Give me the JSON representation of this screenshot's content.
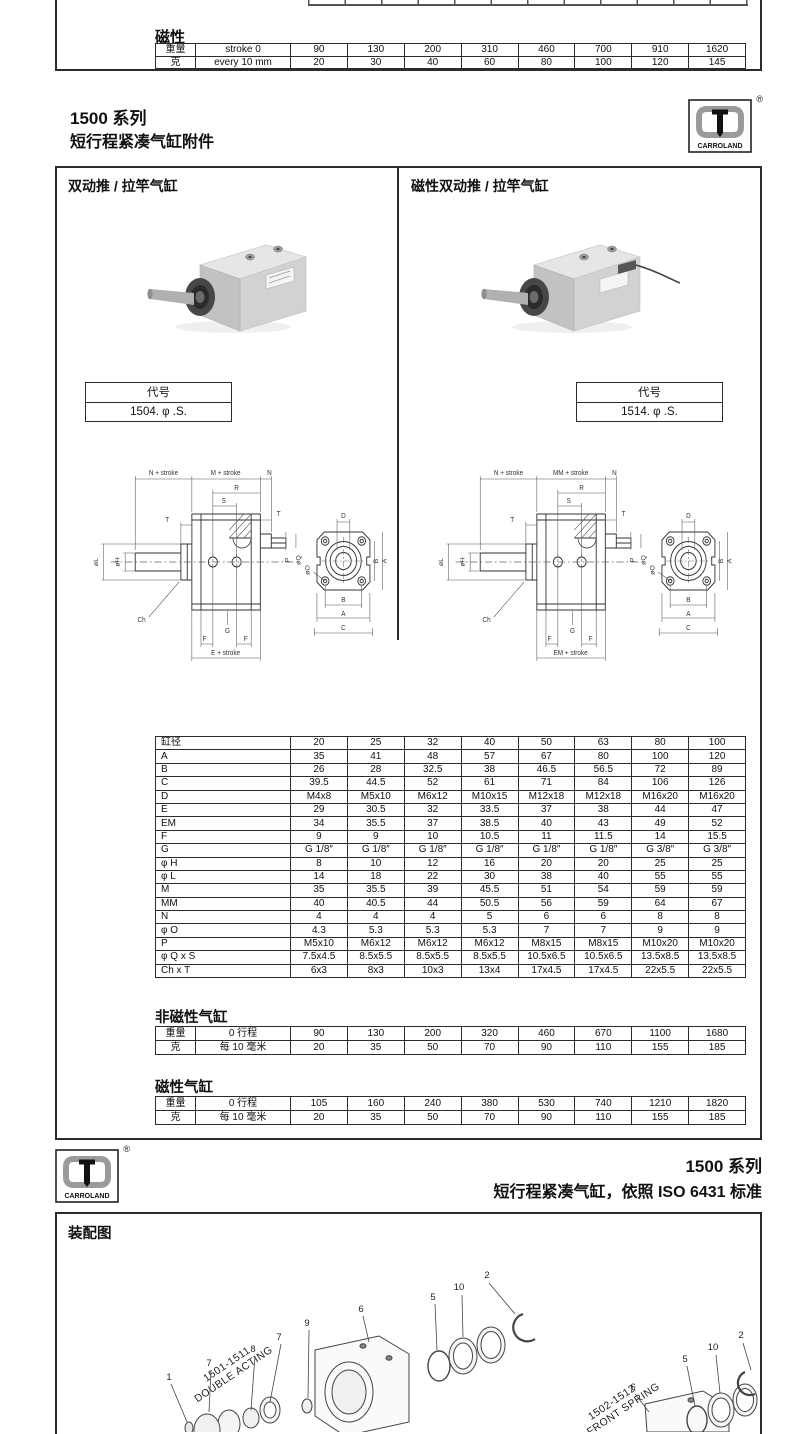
{
  "top_remnant": {
    "heading": "磁性",
    "table": {
      "rows": [
        [
          "重量",
          "stroke 0",
          "90",
          "130",
          "200",
          "310",
          "460",
          "700",
          "910",
          "1620"
        ],
        [
          "克",
          "every 10 mm",
          "20",
          "30",
          "40",
          "60",
          "80",
          "100",
          "120",
          "145"
        ]
      ]
    }
  },
  "header": {
    "series": "1500 系列",
    "subtitle": "短行程紧凑气缸附件",
    "logo": {
      "text": "CARROLAND",
      "reg": "®"
    }
  },
  "main": {
    "left": {
      "title": "双动推 / 拉竿气缸",
      "code_header": "代号",
      "code": "1504. φ .S.",
      "drawing": {
        "n_stroke": "N + stroke",
        "m_stroke": "M + stroke",
        "n": "N",
        "r": "R",
        "s": "S",
        "t_left": "T",
        "t_right": "T",
        "p": "P",
        "oq": "øQ",
        "ol": "øL",
        "oh": "øH",
        "ch": "Ch",
        "g": "G",
        "f_left": "F",
        "f_right": "F",
        "e_stroke": "E + stroke",
        "d": "D",
        "b_right": "B",
        "a_right": "A",
        "oo": "øO",
        "b_bottom": "B",
        "a_bottom": "A",
        "c_bottom": "C"
      }
    },
    "right": {
      "title": "磁性双动推 / 拉竿气缸",
      "code_header": "代号",
      "code": "1514. φ .S.",
      "drawing": {
        "n_stroke": "N + stroke",
        "m_stroke": "MM + stroke",
        "n": "N",
        "r": "R",
        "s": "S",
        "t_left": "T",
        "t_right": "T",
        "p": "P",
        "oq": "øQ",
        "ol": "øL",
        "oh": "øH",
        "ch": "Ch",
        "g": "G",
        "f_left": "F",
        "f_right": "F",
        "e_stroke": "EM + stroke",
        "d": "D",
        "b_right": "B",
        "a_right": "A",
        "oo": "øO",
        "b_bottom": "B",
        "a_bottom": "A",
        "c_bottom": "C"
      }
    },
    "dimension_table": {
      "rows": [
        [
          "缸径",
          "20",
          "25",
          "32",
          "40",
          "50",
          "63",
          "80",
          "100"
        ],
        [
          "A",
          "35",
          "41",
          "48",
          "57",
          "67",
          "80",
          "100",
          "120"
        ],
        [
          "B",
          "26",
          "28",
          "32.5",
          "38",
          "46.5",
          "56.5",
          "72",
          "89"
        ],
        [
          "C",
          "39.5",
          "44.5",
          "52",
          "61",
          "71",
          "84",
          "106",
          "126"
        ],
        [
          "D",
          "M4x8",
          "M5x10",
          "M6x12",
          "M10x15",
          "M12x18",
          "M12x18",
          "M16x20",
          "M16x20"
        ],
        [
          "E",
          "29",
          "30.5",
          "32",
          "33.5",
          "37",
          "38",
          "44",
          "47"
        ],
        [
          "EM",
          "34",
          "35.5",
          "37",
          "38.5",
          "40",
          "43",
          "49",
          "52"
        ],
        [
          "F",
          "9",
          "9",
          "10",
          "10.5",
          "11",
          "11.5",
          "14",
          "15.5"
        ],
        [
          "G",
          "G 1/8″",
          "G 1/8″",
          "G 1/8″",
          "G 1/8″",
          "G 1/8″",
          "G 1/8″",
          "G 3/8″",
          "G 3/8″"
        ],
        [
          "φ H",
          "8",
          "10",
          "12",
          "16",
          "20",
          "20",
          "25",
          "25"
        ],
        [
          "φ L",
          "14",
          "18",
          "22",
          "30",
          "38",
          "40",
          "55",
          "55"
        ],
        [
          "M",
          "35",
          "35.5",
          "39",
          "45.5",
          "51",
          "54",
          "59",
          "59"
        ],
        [
          "MM",
          "40",
          "40.5",
          "44",
          "50.5",
          "56",
          "59",
          "64",
          "67"
        ],
        [
          "N",
          "4",
          "4",
          "4",
          "5",
          "6",
          "6",
          "8",
          "8"
        ],
        [
          "φ O",
          "4.3",
          "5.3",
          "5.3",
          "5.3",
          "7",
          "7",
          "9",
          "9"
        ],
        [
          "P",
          "M5x10",
          "M6x12",
          "M6x12",
          "M6x12",
          "M8x15",
          "M8x15",
          "M10x20",
          "M10x20"
        ],
        [
          "φ Q x S",
          "7.5x4.5",
          "8.5x5.5",
          "8.5x5.5",
          "8.5x5.5",
          "10.5x6.5",
          "10.5x6.5",
          "13.5x8.5",
          "13.5x8.5"
        ],
        [
          "Ch x T",
          "6x3",
          "8x3",
          "10x3",
          "13x4",
          "17x4.5",
          "17x4.5",
          "22x5.5",
          "22x5.5"
        ]
      ]
    },
    "nonmagnetic": {
      "heading": "非磁性气缸",
      "table": {
        "rows": [
          [
            "重量",
            "0 行程",
            "90",
            "130",
            "200",
            "320",
            "460",
            "670",
            "1100",
            "1680"
          ],
          [
            "克",
            "每 10 毫米",
            "20",
            "35",
            "50",
            "70",
            "90",
            "110",
            "155",
            "185"
          ]
        ]
      }
    },
    "magnetic": {
      "heading": "磁性气缸",
      "table": {
        "rows": [
          [
            "重量",
            "0 行程",
            "105",
            "160",
            "240",
            "380",
            "530",
            "740",
            "1210",
            "1820"
          ],
          [
            "克",
            "每 10 毫米",
            "20",
            "35",
            "50",
            "70",
            "90",
            "110",
            "155",
            "185"
          ]
        ]
      }
    }
  },
  "footer": {
    "series": "1500 系列",
    "subtitle": "短行程紧凑气缸，依照 ISO  6431 标准",
    "logo": {
      "text": "CARROLAND",
      "reg": "®"
    }
  },
  "assembly": {
    "heading": "装配图",
    "left_label_1": "1501-1511",
    "left_label_2": "DOUBLE ACTING",
    "right_label_1": "1502-1512",
    "right_label_2": "S-FRONT SPRING",
    "left_callouts": {
      "c1": "1",
      "c2": "2",
      "c5": "5",
      "c6": "6",
      "c7a": "7",
      "c7b": "7",
      "c8": "8",
      "c9": "9",
      "c10": "10"
    },
    "right_callouts": {
      "c2": "2",
      "c5": "5",
      "c6": "6",
      "c10": "10"
    }
  },
  "colors": {
    "ink": "#2b2b2b",
    "logo_gray": "#9a9a9a"
  }
}
